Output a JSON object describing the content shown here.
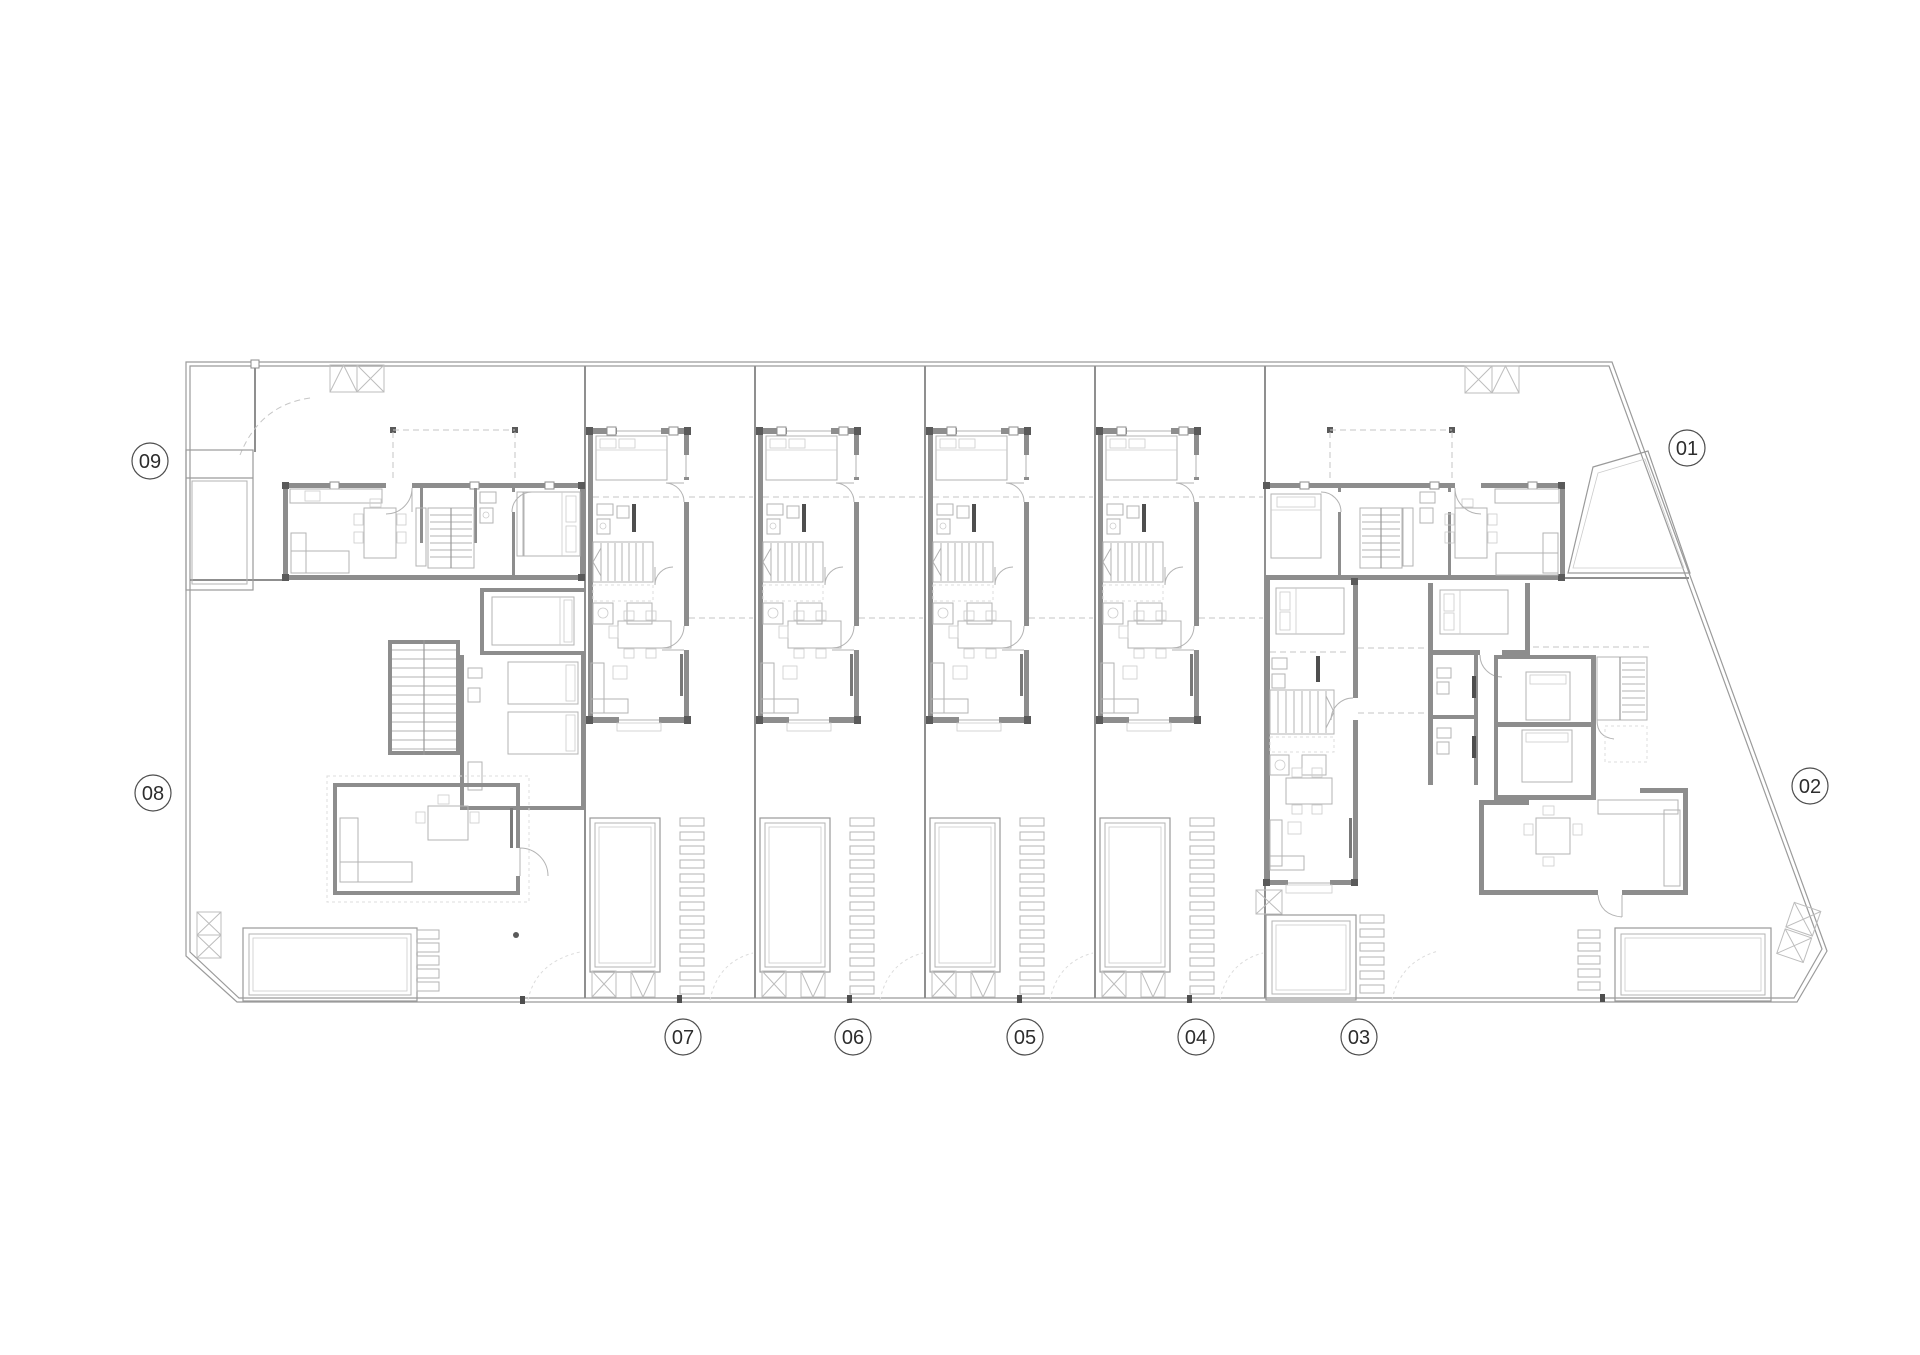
{
  "plan": {
    "unit_labels": [
      {
        "id": "01",
        "cx": 1687,
        "cy": 448
      },
      {
        "id": "02",
        "cx": 1810,
        "cy": 786
      },
      {
        "id": "03",
        "cx": 1359,
        "cy": 1037
      },
      {
        "id": "04",
        "cx": 1196,
        "cy": 1037
      },
      {
        "id": "05",
        "cx": 1025,
        "cy": 1037
      },
      {
        "id": "06",
        "cx": 853,
        "cy": 1037
      },
      {
        "id": "07",
        "cx": 683,
        "cy": 1037
      },
      {
        "id": "08",
        "cx": 153,
        "cy": 793
      },
      {
        "id": "09",
        "cx": 150,
        "cy": 461
      }
    ]
  }
}
